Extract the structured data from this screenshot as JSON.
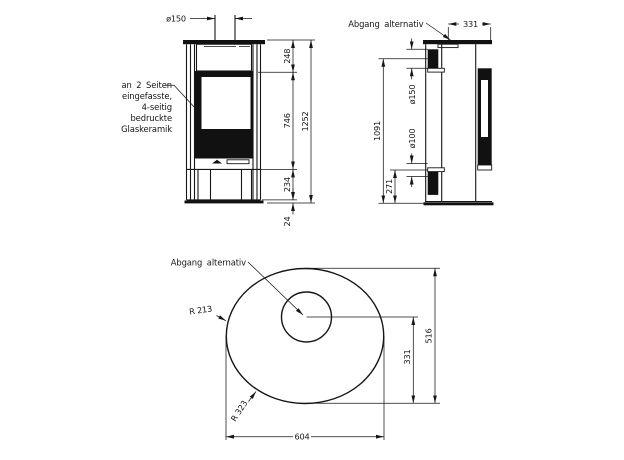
{
  "front_view": {
    "flue_diameter": "ø150",
    "glass_note": [
      "an 2 Seiten",
      "eingefasste,",
      "4-seitig",
      "bedruckte",
      "Glaskeramik"
    ],
    "dim_top_section": "248",
    "dim_glass_section": "746",
    "dim_base_section": "234",
    "dim_plinth": "24",
    "dim_total_height": "1252"
  },
  "side_view": {
    "outlet_label": "Abgang alternativ",
    "dim_outlet_to_front": "331",
    "dim_flue_center_height": "1091",
    "dim_flue_diameter": "ø150",
    "dim_air_diameter": "ø100",
    "dim_air_center_height": "271"
  },
  "top_view": {
    "outlet_label": "Abgang alternativ",
    "dim_radius_small": "R 213",
    "dim_radius_large": "R 323",
    "dim_depth": "516",
    "dim_outlet_to_front": "331",
    "dim_width": "604"
  },
  "colors": {
    "line": "#161616",
    "background": "#ffffff"
  }
}
